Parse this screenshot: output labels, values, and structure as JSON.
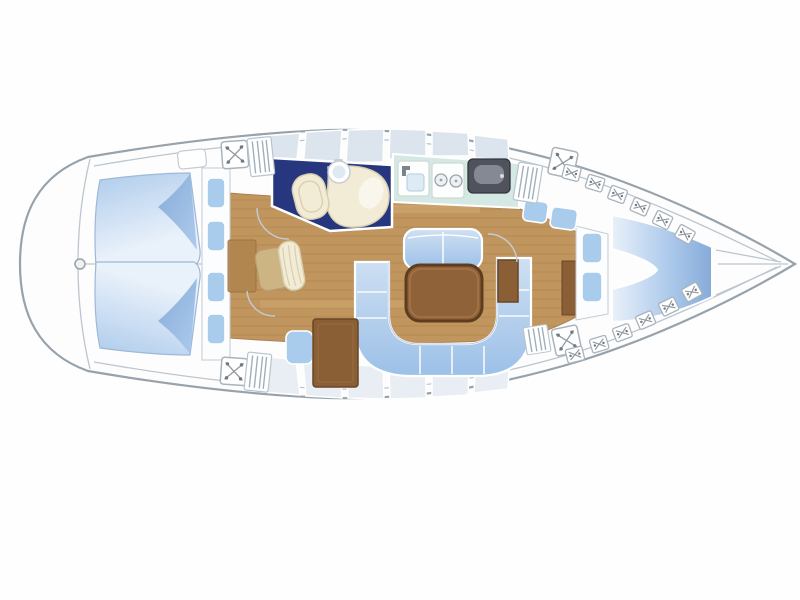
{
  "title": "Sailing yacht interior deck plan (top view, bow to the right)",
  "colors": {
    "hull_line": "#97a2ab",
    "inner_line": "#bcc6ce",
    "deck": "#fdfdfe",
    "wood": "#c0965e",
    "wood_line": "#a57c48",
    "navy_floor": "#26377f",
    "cream": "#f2ecd6",
    "cream_line": "#d8cfae",
    "galley_counter": "#d5e9e4",
    "appliance_white": "#fdfefe",
    "oven_dark": "#50525c",
    "oven_sheen": "#8d939e",
    "table_brown": "#8f6239",
    "table_border": "#5e3c20",
    "cabinet_brown": "#8a5f36",
    "cabinet_border": "#6b4524",
    "cushion_blue": "#a9ccec",
    "berth_light": "#e9f1fa",
    "berth_mid": "#aecbec",
    "berth_deep": "#86abd8",
    "settee_light": "#cfe0f2",
    "settee_deep": "#9cc0e8",
    "seat_tan": "#cdb483",
    "icon_line": "#8f99a2"
  },
  "regions": {
    "hull": "Yacht hull outline, bow pointing right",
    "stern_platform": "Rounded stern platform and transom",
    "aft_cabin_top": "Aft cabin double berth (upper)",
    "aft_cabin_bottom": "Aft cabin double berth (lower)",
    "aft_steps": "Aft cabin entry steps and cushions",
    "head": "Head compartment with toilet and washbasin",
    "toilet": "Toilet",
    "washbasin": "Round washbasin",
    "vanity": "Vanity unit",
    "galley": "Galley counter",
    "galley_sink": "Galley sink with faucet",
    "stove": "Two-burner stove",
    "oven": "Oven / icebox unit",
    "companionway": "Companionway steps",
    "saloon_floor": "Saloon wood floor",
    "dinette_table": "Saloon dining table",
    "u_settee": "U-shaped settee",
    "bench_settee": "Straight settee bench",
    "nav_chair": "Navigator's chair",
    "nav_seat": "Navigation seat cushion",
    "chart_table": "Chart table cabinet",
    "fwd_bulkhead": "Forward cabin bulkhead with shelves",
    "fwd_cushions": "Forward cabin shelf cushions",
    "v_berth": "Forward cabin V-berth",
    "anchor_locker": "Bow anchor locker",
    "deck_hatch": "Deck hatch",
    "vent_grille": "Louvered grille / steps",
    "toe_rail": "Toe-rail deck fitting"
  }
}
